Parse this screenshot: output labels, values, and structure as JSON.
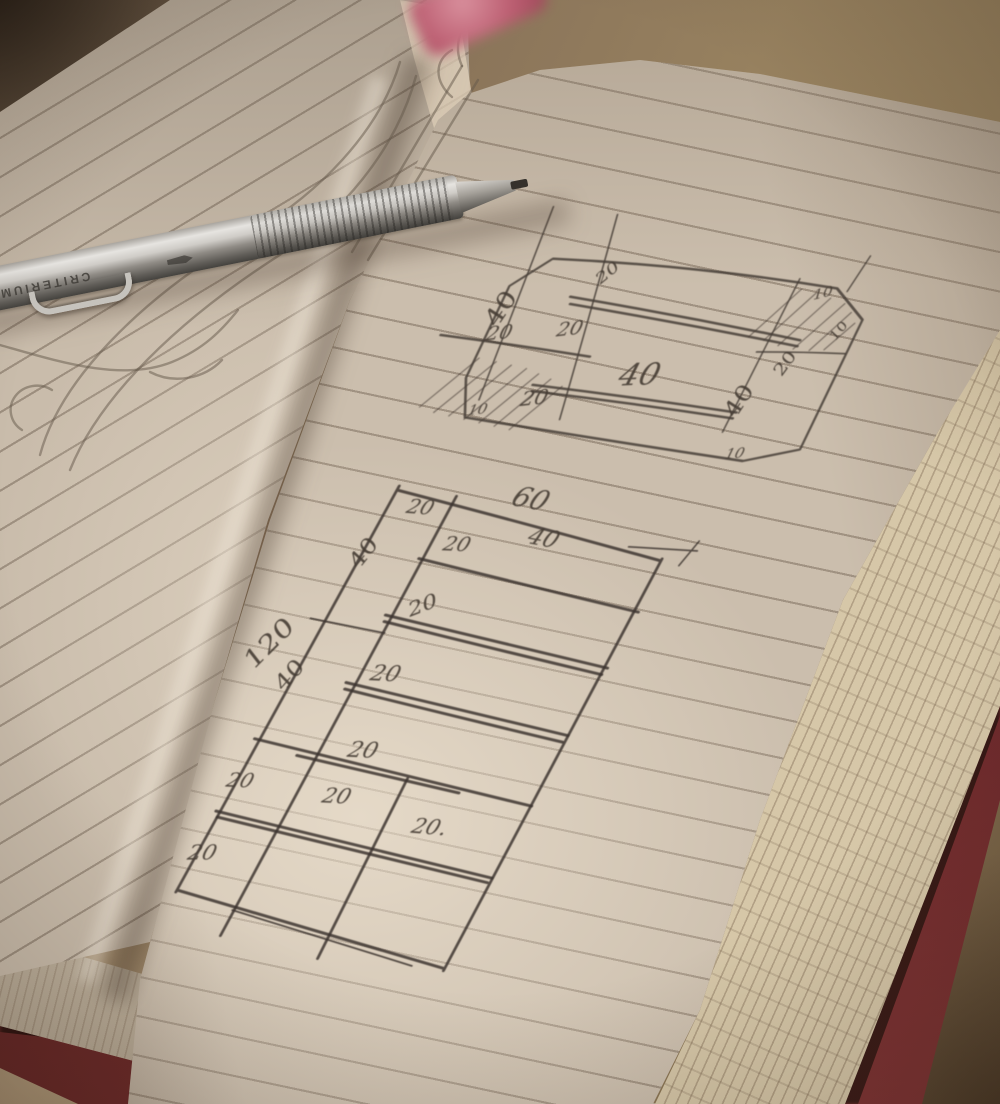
{
  "scene": {
    "description": "Photograph of an open lined notebook with hand-drawn furniture dimension sketches, a silver mechanical pencil across the pages and a pink eraser at top"
  },
  "pencil": {
    "brand": "CRITERIUM"
  },
  "top_diagram": {
    "labels": [
      "40",
      "20",
      "20",
      "20",
      "40",
      "20",
      "10",
      "40",
      "10",
      "10",
      "10",
      "20"
    ]
  },
  "bottom_diagram": {
    "labels": [
      "20",
      "60",
      "40",
      "20",
      "20",
      "20",
      "20",
      "40",
      "120",
      "40",
      "20",
      "20",
      "20.",
      "20"
    ]
  },
  "colors": {
    "table": "#8a755c",
    "paper": "#cbbead",
    "graphite": "#453c34",
    "cover_red": "#6e2a2c",
    "page_stack": "#d6c7a8",
    "eraser_pink": "#bc5f72",
    "pencil_silver": "#cfccc7"
  }
}
